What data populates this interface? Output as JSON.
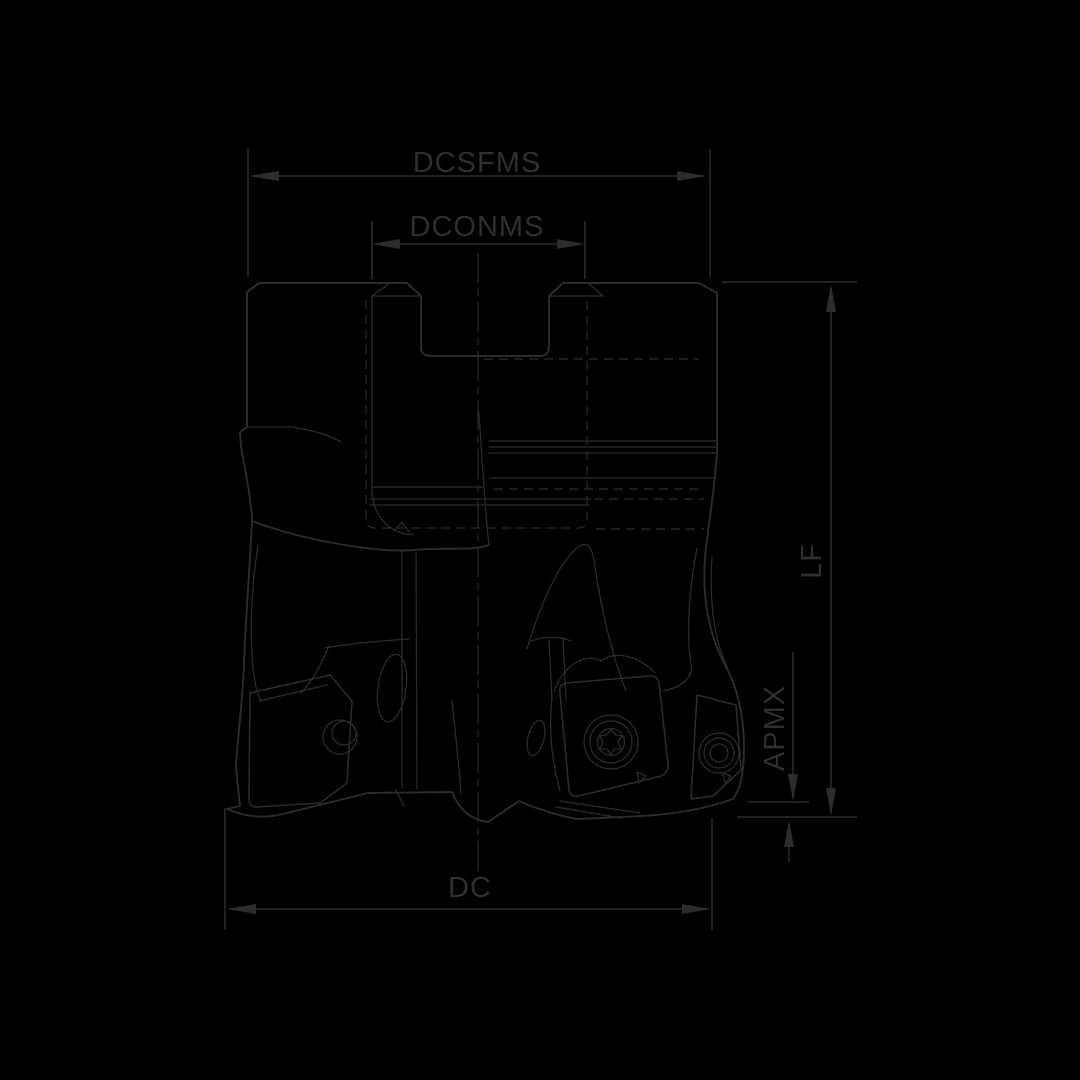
{
  "drawing": {
    "subject": "face-milling-cutter-side-view-line-drawing",
    "background_color": "#000000",
    "line_color": "#2c2c2c",
    "label_color": "#2f2f2f",
    "labels": {
      "dcsfms": "DCSFMS",
      "dconms": "DCONMS",
      "lf": "LF",
      "apmx": "APMX",
      "dc": "DC"
    }
  }
}
